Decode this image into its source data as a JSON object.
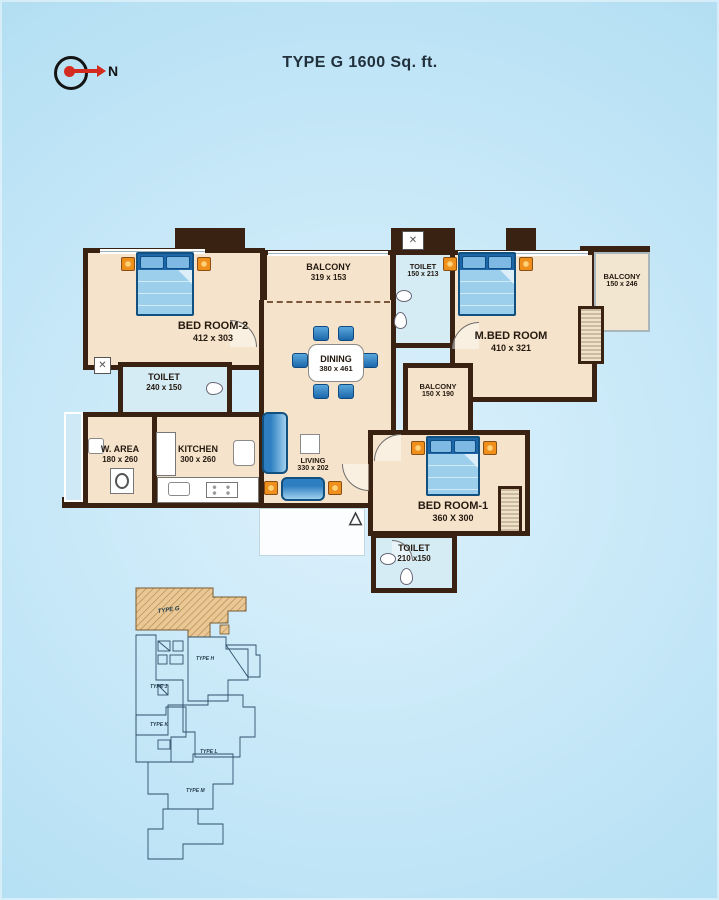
{
  "title": "TYPE G 1600 Sq. ft.",
  "compass": {
    "label": "N"
  },
  "icons": {
    "entrance": "△",
    "duct": "✕"
  },
  "colors": {
    "wall": "#3a2213",
    "floor": "#f6e3cb",
    "wet_floor": "#d6ecf5",
    "furniture_blue": "#2e7fc2",
    "lamp_orange": "#ef8f1c",
    "background_blue": "#b9e2f5",
    "keyplan_line": "#2f4f6a",
    "keyplan_highlight": "#e9c896"
  },
  "rooms": {
    "bedroom2": {
      "name": "BED ROOM-2",
      "dims": "412 x 303"
    },
    "balcony_top": {
      "name": "BALCONY",
      "dims": "319 x 153"
    },
    "toilet_top": {
      "name": "TOILET",
      "dims": "150 x 213"
    },
    "mbedroom": {
      "name": "M.BED ROOM",
      "dims": "410 x 321"
    },
    "balcony_right": {
      "name": "BALCONY",
      "dims": "150 x 246"
    },
    "dining": {
      "name": "DINING",
      "dims": "380 x 461"
    },
    "toilet_left": {
      "name": "TOILET",
      "dims": "240 x 150"
    },
    "balcony_mid": {
      "name": "BALCONY",
      "dims": "150 X 190"
    },
    "warea": {
      "name": "W. AREA",
      "dims": "180 x 260"
    },
    "kitchen": {
      "name": "KITCHEN",
      "dims": "300 x 260"
    },
    "living": {
      "name": "LIVING",
      "dims": "330 x 202"
    },
    "bedroom1": {
      "name": "BED ROOM-1",
      "dims": "360 X 300"
    },
    "toilet_bottom": {
      "name": "TOILET",
      "dims": "210 x150"
    }
  },
  "keyplan": {
    "highlight": "TYPE G",
    "units": [
      "TYPE H",
      "TYPE J",
      "TYPE K",
      "TYPE L",
      "TYPE M"
    ]
  }
}
